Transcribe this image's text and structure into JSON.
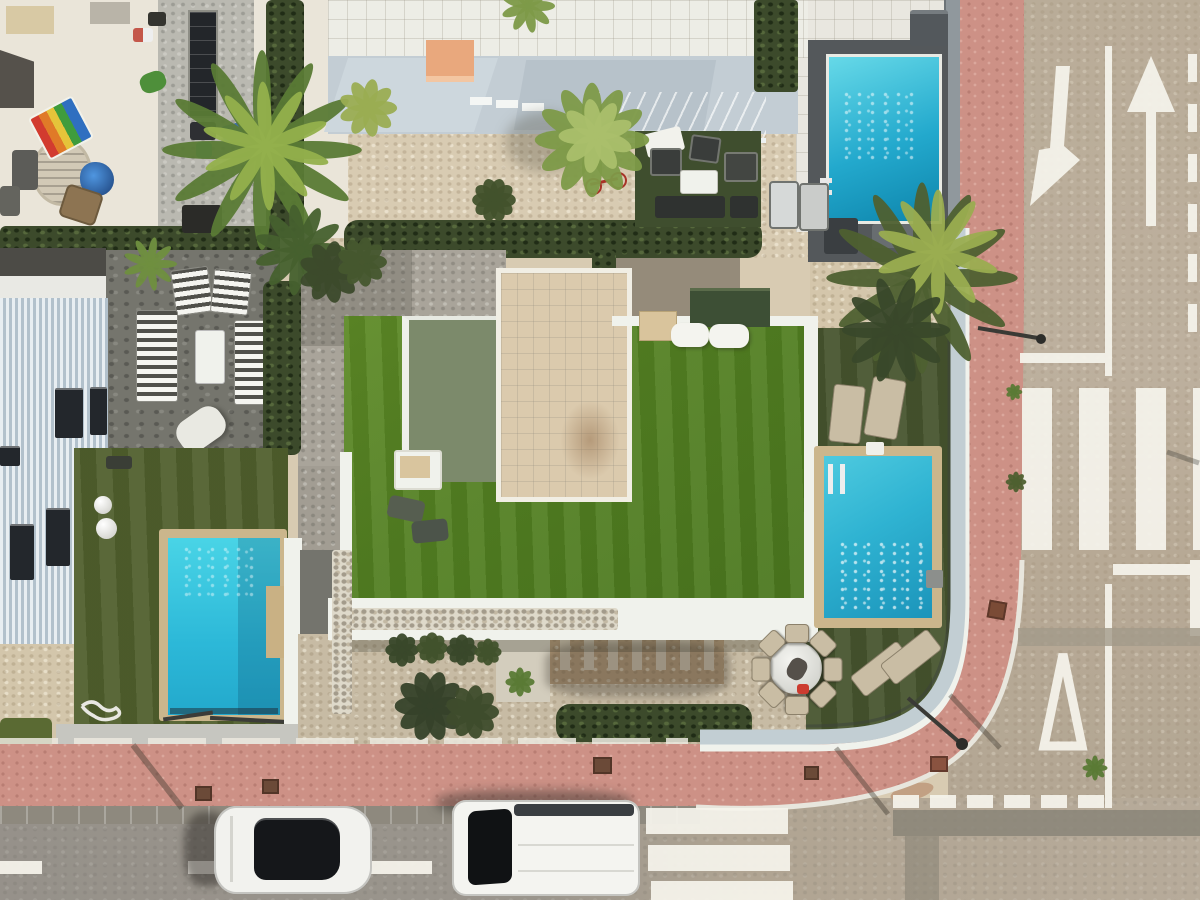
{
  "scene": {
    "type": "aerial-drone-photo",
    "alt": "Top-down aerial view of a modern villa with artificial lawn, three swimming pools, neighbouring terraces, pink paved sidewalks, an asphalt road with white arrows, zebra crossing, give-way markings and two parked white cars",
    "objects": {
      "swimming_pools": 3,
      "parked_cars": 2,
      "palm_trees": 3,
      "sun_loungers": 10,
      "dining_chairs": 8,
      "road_markings": [
        "left-turn-arrow",
        "straight-ahead-arrow",
        "lane-divider-line",
        "edge-dashed-line",
        "zebra-crossing",
        "stop-line",
        "give-way-triangle",
        "give-way-dashed-line",
        "pedestrian-crossing",
        "centre-dashed-line"
      ]
    }
  },
  "palette": {
    "sand": "#d8cbb2",
    "terrace": "#eae5d9",
    "concrete": "#bab9b1",
    "stone": "#75756d",
    "roadA": "#b9ac98",
    "roadB": "#99948b",
    "curb": "#8e897e",
    "pink": "#cd9186",
    "white": "#f0f2ec",
    "wallBlue": "#c3cdd4",
    "orange": "#e9a87d",
    "hedge": "#3c4a2b",
    "lawn": "#538022",
    "lawnLight": "#5d8a26",
    "lawnDeep": "#4a761e",
    "turfDark": "#46542e",
    "turfOlive": "#505f2d",
    "roofBeige": "#dbcaad",
    "roofGreen": "#7c8a6b",
    "pergola": "#3d4f35",
    "coping": "#cbb68c",
    "tan": "#c9bda4",
    "deckDark": "#54585b",
    "poolLight": "#49d4e6",
    "poolDeep": "#1b94ba",
    "glassBlack": "#15171a",
    "marking": "#f6f4ec",
    "pebble": "#ded9ca",
    "bandBlue": "#c2ced3"
  },
  "dining": {
    "cx": 796,
    "cy": 668,
    "r": 36,
    "count": 8,
    "w": 22,
    "h": 17
  },
  "palms": [
    {
      "name": "palm-tree-large",
      "x": 262,
      "y": 150,
      "r": 96,
      "ry": 9,
      "color": "#5a7a35",
      "fronds": 12
    },
    {
      "name": "palm-tree-large-light",
      "x": 266,
      "y": 146,
      "r": 62,
      "ry": 7,
      "color": "#93b04c",
      "fronds": 10,
      "rot": 15
    },
    {
      "name": "palm-tree-east",
      "x": 922,
      "y": 278,
      "r": 92,
      "ry": 9,
      "color": "#4e6030",
      "fronds": 12
    },
    {
      "name": "palm-tree-east-light",
      "x": 938,
      "y": 252,
      "r": 60,
      "ry": 7,
      "color": "#9aad50",
      "fronds": 10,
      "rot": 18
    },
    {
      "name": "palm-tree-east-dark",
      "x": 896,
      "y": 330,
      "r": 52,
      "ry": 8,
      "color": "#39482a",
      "fronds": 10
    },
    {
      "name": "palm-small-patio",
      "x": 150,
      "y": 264,
      "r": 26,
      "ry": 4,
      "color": "#6f8f3f",
      "fronds": 9
    },
    {
      "name": "grass-bush-large",
      "x": 592,
      "y": 140,
      "r": 55,
      "ry": 10,
      "color": "#7d9a48",
      "fronds": 12
    },
    {
      "name": "grass-bush-large-light",
      "x": 596,
      "y": 136,
      "r": 36,
      "ry": 8,
      "color": "#aabf6b",
      "fronds": 9,
      "rot": 20
    },
    {
      "name": "palm-hedge",
      "x": 300,
      "y": 250,
      "r": 44,
      "ry": 7,
      "color": "#46602e",
      "fronds": 11
    },
    {
      "name": "bush-yellow",
      "x": 368,
      "y": 108,
      "r": 28,
      "ry": 7,
      "color": "#9aad52",
      "fronds": 9
    },
    {
      "name": "palm-top-edge",
      "x": 528,
      "y": 6,
      "r": 26,
      "ry": 5,
      "color": "#7d9a48",
      "fronds": 9
    },
    {
      "name": "bush-gravel-1",
      "x": 330,
      "y": 272,
      "r": 30,
      "ry": 8,
      "color": "#3c4a2b",
      "fronds": 9
    },
    {
      "name": "bush-gravel-2",
      "x": 362,
      "y": 262,
      "r": 24,
      "ry": 7,
      "color": "#46572e",
      "fronds": 9
    },
    {
      "name": "bush-ball-1",
      "x": 402,
      "y": 650,
      "r": 16,
      "ry": 6,
      "color": "#39482a",
      "fronds": 8
    },
    {
      "name": "bush-ball-2",
      "x": 432,
      "y": 648,
      "r": 15,
      "ry": 6,
      "color": "#41522c",
      "fronds": 8
    },
    {
      "name": "bush-ball-3",
      "x": 462,
      "y": 650,
      "r": 15,
      "ry": 6,
      "color": "#39482a",
      "fronds": 8
    },
    {
      "name": "bush-ball-4",
      "x": 488,
      "y": 652,
      "r": 13,
      "ry": 5,
      "color": "#41522c",
      "fronds": 8
    },
    {
      "name": "bush-cluster-1",
      "x": 430,
      "y": 706,
      "r": 34,
      "ry": 9,
      "color": "#36422a",
      "fronds": 10
    },
    {
      "name": "bush-cluster-2",
      "x": 472,
      "y": 712,
      "r": 26,
      "ry": 8,
      "color": "#3e4c2c",
      "fronds": 9
    },
    {
      "name": "tuft-sidewalk-1",
      "x": 1016,
      "y": 482,
      "r": 10,
      "ry": 3,
      "color": "#4e6030",
      "fronds": 8
    },
    {
      "name": "tuft-sidewalk-2",
      "x": 1014,
      "y": 392,
      "r": 8,
      "ry": 2.5,
      "color": "#5a7a35",
      "fronds": 7
    },
    {
      "name": "tuft-hedge",
      "x": 520,
      "y": 682,
      "r": 14,
      "ry": 4,
      "color": "#5a7a35",
      "fronds": 8
    },
    {
      "name": "tuft-road-edge",
      "x": 1095,
      "y": 768,
      "r": 12,
      "ry": 3,
      "color": "#5a7a35",
      "fronds": 8
    },
    {
      "name": "round-bush",
      "x": 494,
      "y": 200,
      "r": 21,
      "ry": 7,
      "color": "#42522c",
      "fronds": 10
    }
  ]
}
